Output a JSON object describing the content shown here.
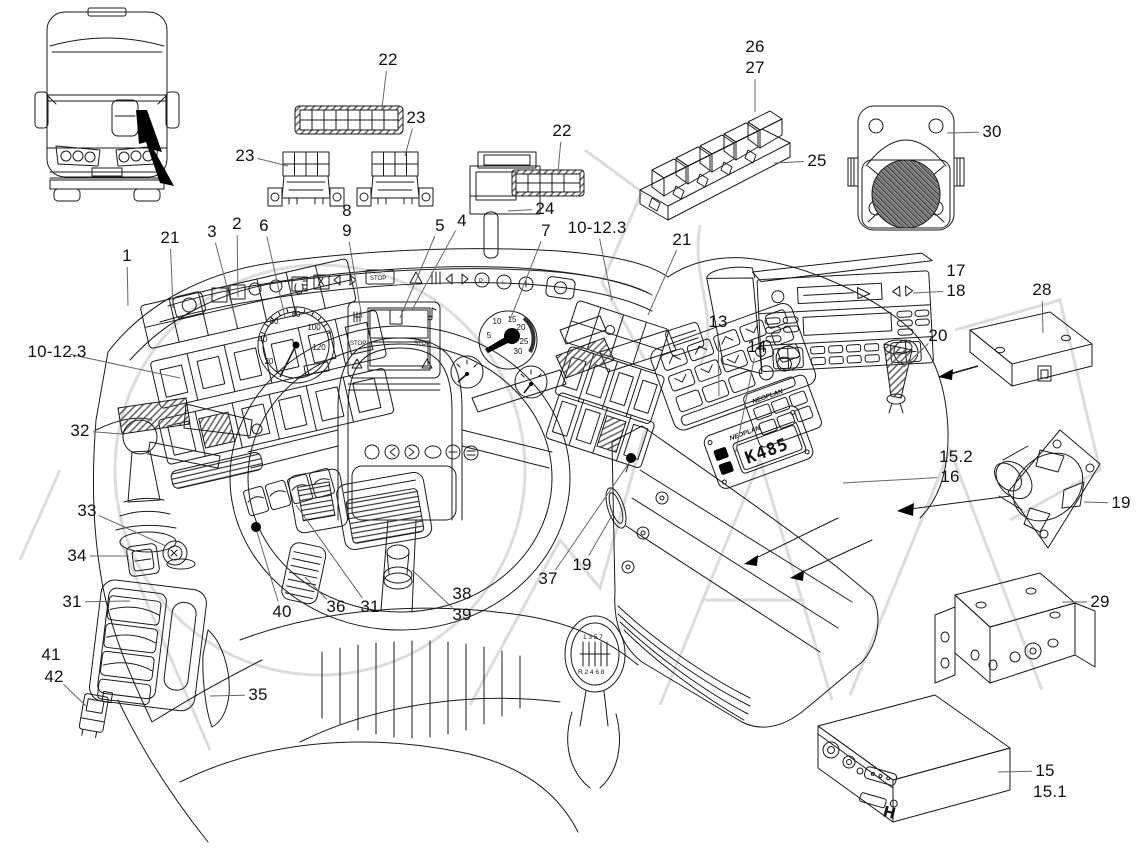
{
  "figure": {
    "description": "Exploded parts diagram of a bus driver cockpit / dashboard with numbered callouts",
    "style": "technical line drawing with light gray watermark"
  },
  "colors": {
    "line": "#1a1a1a",
    "leader": "#6b6b6b",
    "watermark": "#c5c5c5",
    "paper": "#ffffff"
  },
  "panel_texts": {
    "lcd_stop_left": "STOP",
    "lcd_stop_right": "STOP",
    "telltale_stop": "STOP",
    "brand_small_panel": "NEOPLAN",
    "brand_display_panel": "NEOPLAN",
    "display_value": "K485",
    "shift_pattern_top": "1 3 5 7",
    "shift_pattern_bottom": "R 2 4 6 8",
    "logo_h": "H"
  },
  "gauges": {
    "speedometer": {
      "points": [
        {
          "t": "20",
          "x": 269,
          "y": 364
        },
        {
          "t": "40",
          "x": 263,
          "y": 342
        },
        {
          "t": "60",
          "x": 274,
          "y": 324
        },
        {
          "t": "80",
          "x": 296,
          "y": 317
        },
        {
          "t": "100",
          "x": 314,
          "y": 330
        },
        {
          "t": "120",
          "x": 319,
          "y": 350
        }
      ]
    },
    "tachometer": {
      "points": [
        {
          "t": "5",
          "x": 489,
          "y": 338
        },
        {
          "t": "10",
          "x": 497,
          "y": 324
        },
        {
          "t": "15",
          "x": 512,
          "y": 322
        },
        {
          "t": "20",
          "x": 521,
          "y": 330
        },
        {
          "t": "25",
          "x": 524,
          "y": 344
        },
        {
          "t": "30",
          "x": 518,
          "y": 354
        }
      ]
    }
  },
  "callouts": [
    {
      "text": "1",
      "x": 127,
      "y": 256,
      "tx": 128,
      "ty": 306
    },
    {
      "text": "21",
      "x": 170,
      "y": 238,
      "tx": 173,
      "ty": 308
    },
    {
      "text": "3",
      "x": 212,
      "y": 232,
      "tx": 237,
      "ty": 325
    },
    {
      "text": "2",
      "x": 237,
      "y": 224,
      "tx": 238,
      "ty": 297
    },
    {
      "text": "6",
      "x": 264,
      "y": 226,
      "tx": 285,
      "ty": 317
    },
    {
      "text": "8",
      "x": 347,
      "y": 211
    },
    {
      "text": "9",
      "x": 347,
      "y": 231,
      "tx": 362,
      "ty": 318
    },
    {
      "text": "5",
      "x": 440,
      "y": 226,
      "tx": 400,
      "ty": 318
    },
    {
      "text": "4",
      "x": 462,
      "y": 221,
      "tx": 412,
      "ty": 310
    },
    {
      "text": "7",
      "x": 546,
      "y": 231,
      "tx": 510,
      "ty": 320
    },
    {
      "text": "10-12.3",
      "x": 597,
      "y": 228,
      "tx": 612,
      "ty": 300
    },
    {
      "text": "21",
      "x": 682,
      "y": 240,
      "tx": 648,
      "ty": 315
    },
    {
      "text": "22",
      "x": 388,
      "y": 60,
      "tx": 382,
      "ty": 108
    },
    {
      "text": "23",
      "x": 245,
      "y": 156,
      "tx": 288,
      "ty": 166
    },
    {
      "text": "23",
      "x": 416,
      "y": 118,
      "tx": 405,
      "ty": 156
    },
    {
      "text": "22",
      "x": 562,
      "y": 131,
      "tx": 558,
      "ty": 172
    },
    {
      "text": "24",
      "x": 545,
      "y": 209,
      "tx": 508,
      "ty": 211
    },
    {
      "text": "26",
      "x": 755,
      "y": 47
    },
    {
      "text": "27",
      "x": 755,
      "y": 68,
      "tx": 755,
      "ty": 112
    },
    {
      "text": "25",
      "x": 817,
      "y": 161,
      "tx": 774,
      "ty": 163
    },
    {
      "text": "30",
      "x": 992,
      "y": 132,
      "tx": 947,
      "ty": 133
    },
    {
      "text": "28",
      "x": 1042,
      "y": 290,
      "tx": 1043,
      "ty": 333
    },
    {
      "text": "17",
      "x": 956,
      "y": 271
    },
    {
      "text": "18",
      "x": 956,
      "y": 291,
      "tx": 913,
      "ty": 293
    },
    {
      "text": "20",
      "x": 938,
      "y": 336,
      "tx": 904,
      "ty": 367
    },
    {
      "text": "10-12.3",
      "x": 57,
      "y": 352,
      "tx": 180,
      "ty": 378
    },
    {
      "text": "32",
      "x": 80,
      "y": 431,
      "tx": 121,
      "ty": 434
    },
    {
      "text": "33",
      "x": 87,
      "y": 511,
      "tx": 166,
      "ty": 546
    },
    {
      "text": "34",
      "x": 77,
      "y": 556,
      "tx": 129,
      "ty": 556
    },
    {
      "text": "31",
      "x": 72,
      "y": 602,
      "tx": 130,
      "ty": 601
    },
    {
      "text": "41",
      "x": 51,
      "y": 655
    },
    {
      "text": "42",
      "x": 54,
      "y": 677,
      "tx": 86,
      "ty": 706
    },
    {
      "text": "35",
      "x": 258,
      "y": 695,
      "tx": 210,
      "ty": 696
    },
    {
      "text": "40",
      "x": 282,
      "y": 612,
      "tx": 257,
      "ty": 532
    },
    {
      "text": "36",
      "x": 336,
      "y": 607,
      "tx": 305,
      "ty": 577
    },
    {
      "text": "31",
      "x": 370,
      "y": 607,
      "tx": 296,
      "ty": 505
    },
    {
      "text": "38",
      "x": 462,
      "y": 594
    },
    {
      "text": "39",
      "x": 462,
      "y": 615,
      "tx": 412,
      "ty": 570
    },
    {
      "text": "37",
      "x": 548,
      "y": 579,
      "tx": 629,
      "ty": 463
    },
    {
      "text": "19",
      "x": 582,
      "y": 565,
      "tx": 614,
      "ty": 512
    },
    {
      "text": "13",
      "x": 718,
      "y": 322,
      "tx": 719,
      "ty": 396
    },
    {
      "text": "14",
      "x": 757,
      "y": 347,
      "tx": 735,
      "ty": 455
    },
    {
      "text": "15.2",
      "x": 956,
      "y": 457
    },
    {
      "text": "16",
      "x": 950,
      "y": 477,
      "tx": 843,
      "ty": 483
    },
    {
      "text": "19",
      "x": 1121,
      "y": 503,
      "tx": 1084,
      "ty": 502
    },
    {
      "text": "29",
      "x": 1100,
      "y": 602,
      "tx": 1062,
      "ty": 602
    },
    {
      "text": "15",
      "x": 1045,
      "y": 771,
      "tx": 998,
      "ty": 772
    },
    {
      "text": "15.1",
      "x": 1050,
      "y": 792
    }
  ]
}
